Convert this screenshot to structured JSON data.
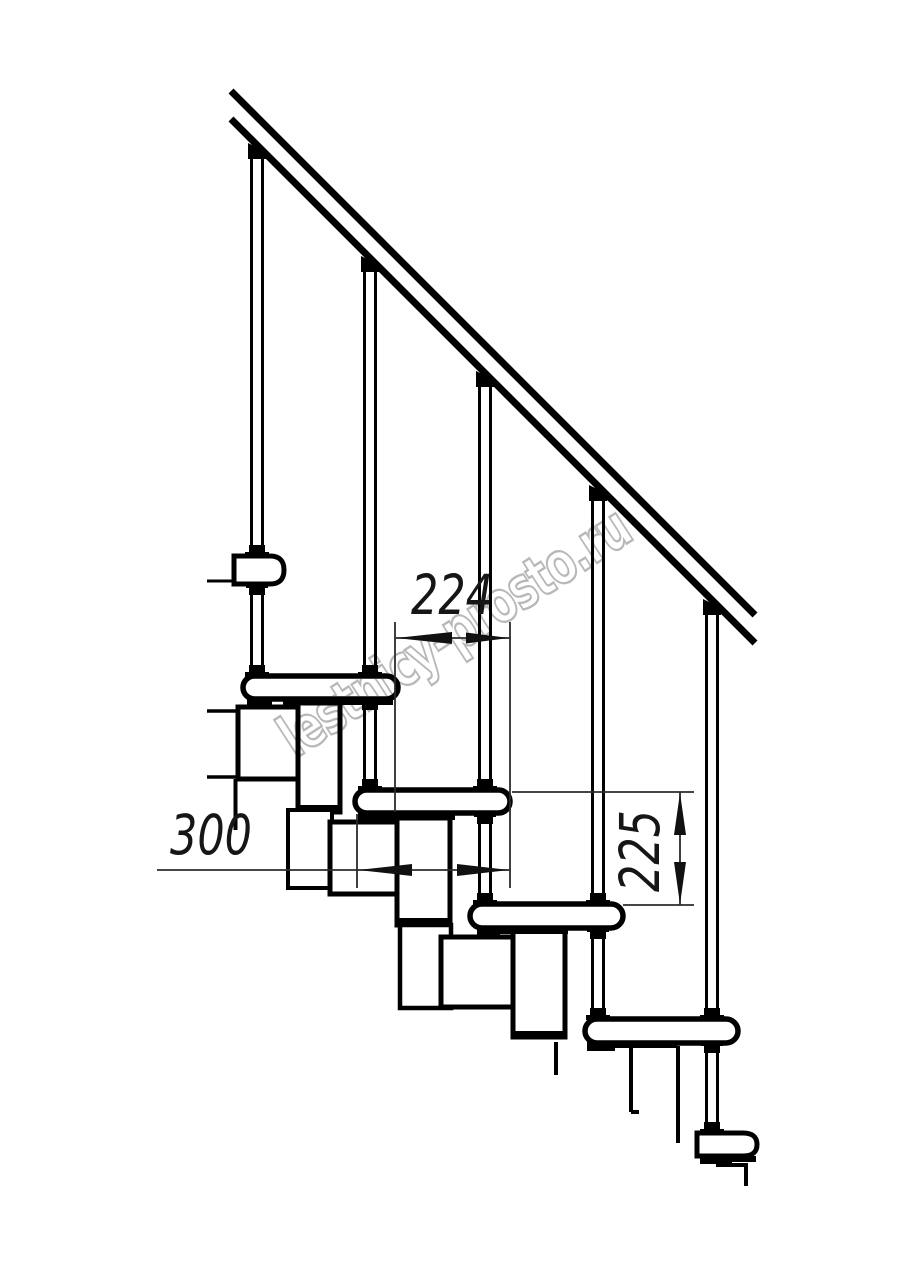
{
  "page": {
    "width": 914,
    "height": 1280,
    "background": "#ffffff"
  },
  "watermark": {
    "text": "lestnicy-prosto.ru",
    "stroke_color": "#b0b0b0"
  },
  "dimensions": {
    "going": {
      "label": "224"
    },
    "tread_depth": {
      "label": "300"
    },
    "rise": {
      "label": "225"
    }
  },
  "colors": {
    "drawing_line": "#000000",
    "dimension_line": "#2b2b2b",
    "dimension_text": "#161616",
    "background": "#ffffff"
  }
}
